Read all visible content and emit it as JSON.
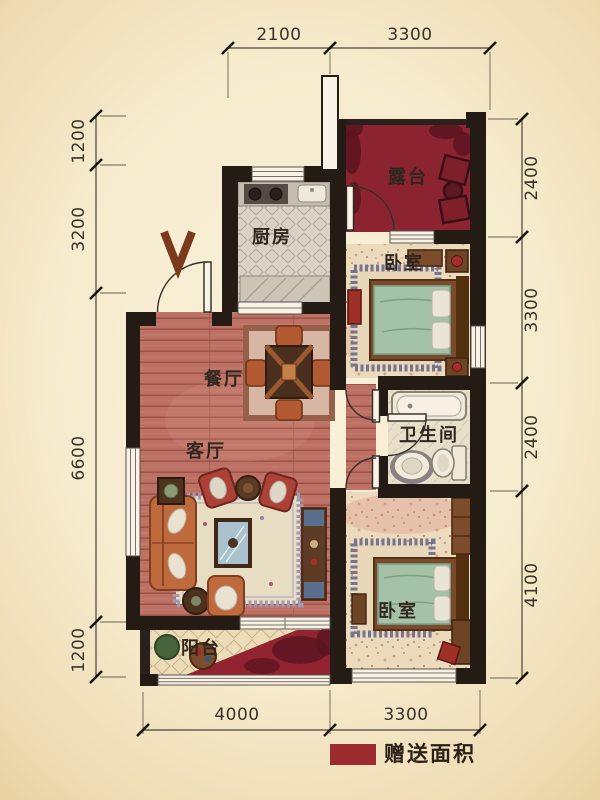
{
  "plan": {
    "rooms": {
      "terrace": {
        "label": "露台"
      },
      "kitchen": {
        "label": "厨房"
      },
      "bedroom_top": {
        "label": "卧室"
      },
      "dining": {
        "label": "餐厅"
      },
      "living": {
        "label": "客厅"
      },
      "bathroom": {
        "label": "卫生间"
      },
      "bedroom_bottom": {
        "label": "卧室"
      },
      "balcony": {
        "label": "阳台"
      }
    },
    "dimensions": {
      "top": [
        "2100",
        "3300"
      ],
      "bottom": [
        "4000",
        "3300"
      ],
      "left": [
        "1200",
        "3200",
        "6600",
        "1200"
      ],
      "right": [
        "2400",
        "3300",
        "2400",
        "4100"
      ]
    },
    "legend": {
      "label": "赠送面积",
      "swatch_color": "#9e2b2f"
    },
    "colors": {
      "terrace_floor": "#8c2330",
      "gift_area": "#92242f",
      "walls": "#241b15",
      "wood_floor": "#bd7164",
      "bed_green": "#a3c2a8"
    }
  }
}
